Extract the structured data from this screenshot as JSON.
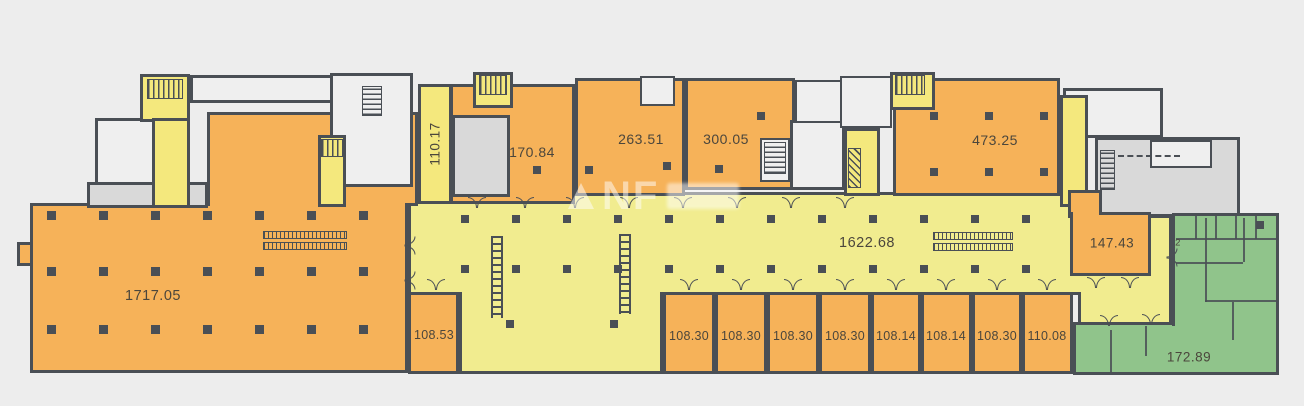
{
  "colors": {
    "background": "#ededed",
    "wall": "#4a4f55",
    "retail": "#f6b259",
    "atrium": "#f1ec8f",
    "core": "#f4e87d",
    "green": "#90c48b",
    "service": "#d9d9d9",
    "service_light": "#efefef",
    "label": "#4b463c"
  },
  "watermark": {
    "text": "NF"
  },
  "rooms": {
    "main_left": {
      "label": "1717.05"
    },
    "atrium": {
      "label": "1622.68"
    },
    "top": [
      {
        "label": "110.17"
      },
      {
        "label": "170.84"
      },
      {
        "label": "263.51"
      },
      {
        "label": "300.05"
      },
      {
        "label": "473.25"
      }
    ],
    "right_small": {
      "label": "147.43"
    },
    "green": {
      "label": "172.89"
    },
    "green_unit": {
      "label": "2"
    },
    "bottom": [
      {
        "label": "108.53"
      },
      {
        "label": "108.30"
      },
      {
        "label": "108.30"
      },
      {
        "label": "108.30"
      },
      {
        "label": "108.30"
      },
      {
        "label": "108.14"
      },
      {
        "label": "108.14"
      },
      {
        "label": "108.30"
      },
      {
        "label": "110.08"
      }
    ]
  }
}
